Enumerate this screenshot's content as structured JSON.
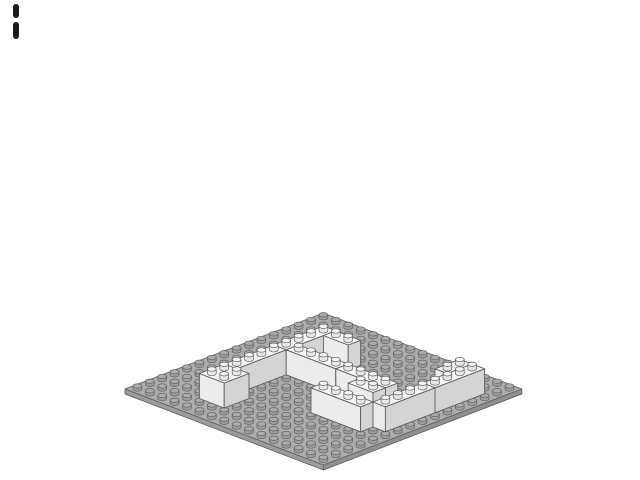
{
  "page": {
    "background": "#ffffff",
    "title": "LEGO model render - 16x16 baseplate with white brick walls"
  },
  "step_indicator": {
    "name": "broken-bar-mark",
    "color": "#1c1c1c",
    "bars": [
      {
        "x": 13,
        "y": 4,
        "w": 6,
        "h": 14
      },
      {
        "x": 13,
        "y": 22,
        "w": 6,
        "h": 17
      }
    ]
  },
  "scene": {
    "description": "Isometric render of a light-gray 16x16 LEGO baseplate with white bricks forming partial walls",
    "baseplate": {
      "part": "16x16 baseplate",
      "studs_x": 16,
      "studs_z": 16,
      "color_top": "#acacac",
      "color_side_left": "#9c9c9c",
      "color_side_right": "#8f8f8f",
      "stud_side": "#9e9e9e",
      "stud_top": "#ababab",
      "outline": "#636363"
    },
    "brick_colors": {
      "top": "#f6f6f6",
      "side_left": "#ececec",
      "side_right": "#d4d4d4",
      "stud_side": "#e7e7e7",
      "stud_top": "#f4f4f4",
      "outline": "#5f5f5f"
    },
    "bricks": [
      {
        "part": "1x4 brick",
        "x": 4,
        "z": 8,
        "w": 1,
        "d": 4
      },
      {
        "part": "1x4 brick",
        "x": 4,
        "z": 4,
        "w": 1,
        "d": 4
      },
      {
        "part": "1x2 brick",
        "x": 5,
        "z": 11,
        "w": 2,
        "d": 1
      },
      {
        "part": "2x2 brick",
        "x": 4,
        "z": 2,
        "w": 2,
        "d": 2
      },
      {
        "part": "1x4 brick",
        "x": 5,
        "z": 8,
        "w": 4,
        "d": 1
      },
      {
        "part": "1x4 brick",
        "x": 9,
        "z": 8,
        "w": 4,
        "d": 1
      },
      {
        "part": "1x2 brick",
        "x": 11,
        "z": 7,
        "w": 2,
        "d": 1
      },
      {
        "part": "1x4 brick",
        "x": 10,
        "z": 5,
        "w": 4,
        "d": 1
      },
      {
        "part": "1x2 brick",
        "x": 13,
        "z": 12,
        "w": 1,
        "d": 2
      },
      {
        "part": "1x4 brick",
        "x": 14,
        "z": 10,
        "w": 1,
        "d": 4
      },
      {
        "part": "1x4 brick",
        "x": 14,
        "z": 6,
        "w": 1,
        "d": 4
      }
    ]
  }
}
